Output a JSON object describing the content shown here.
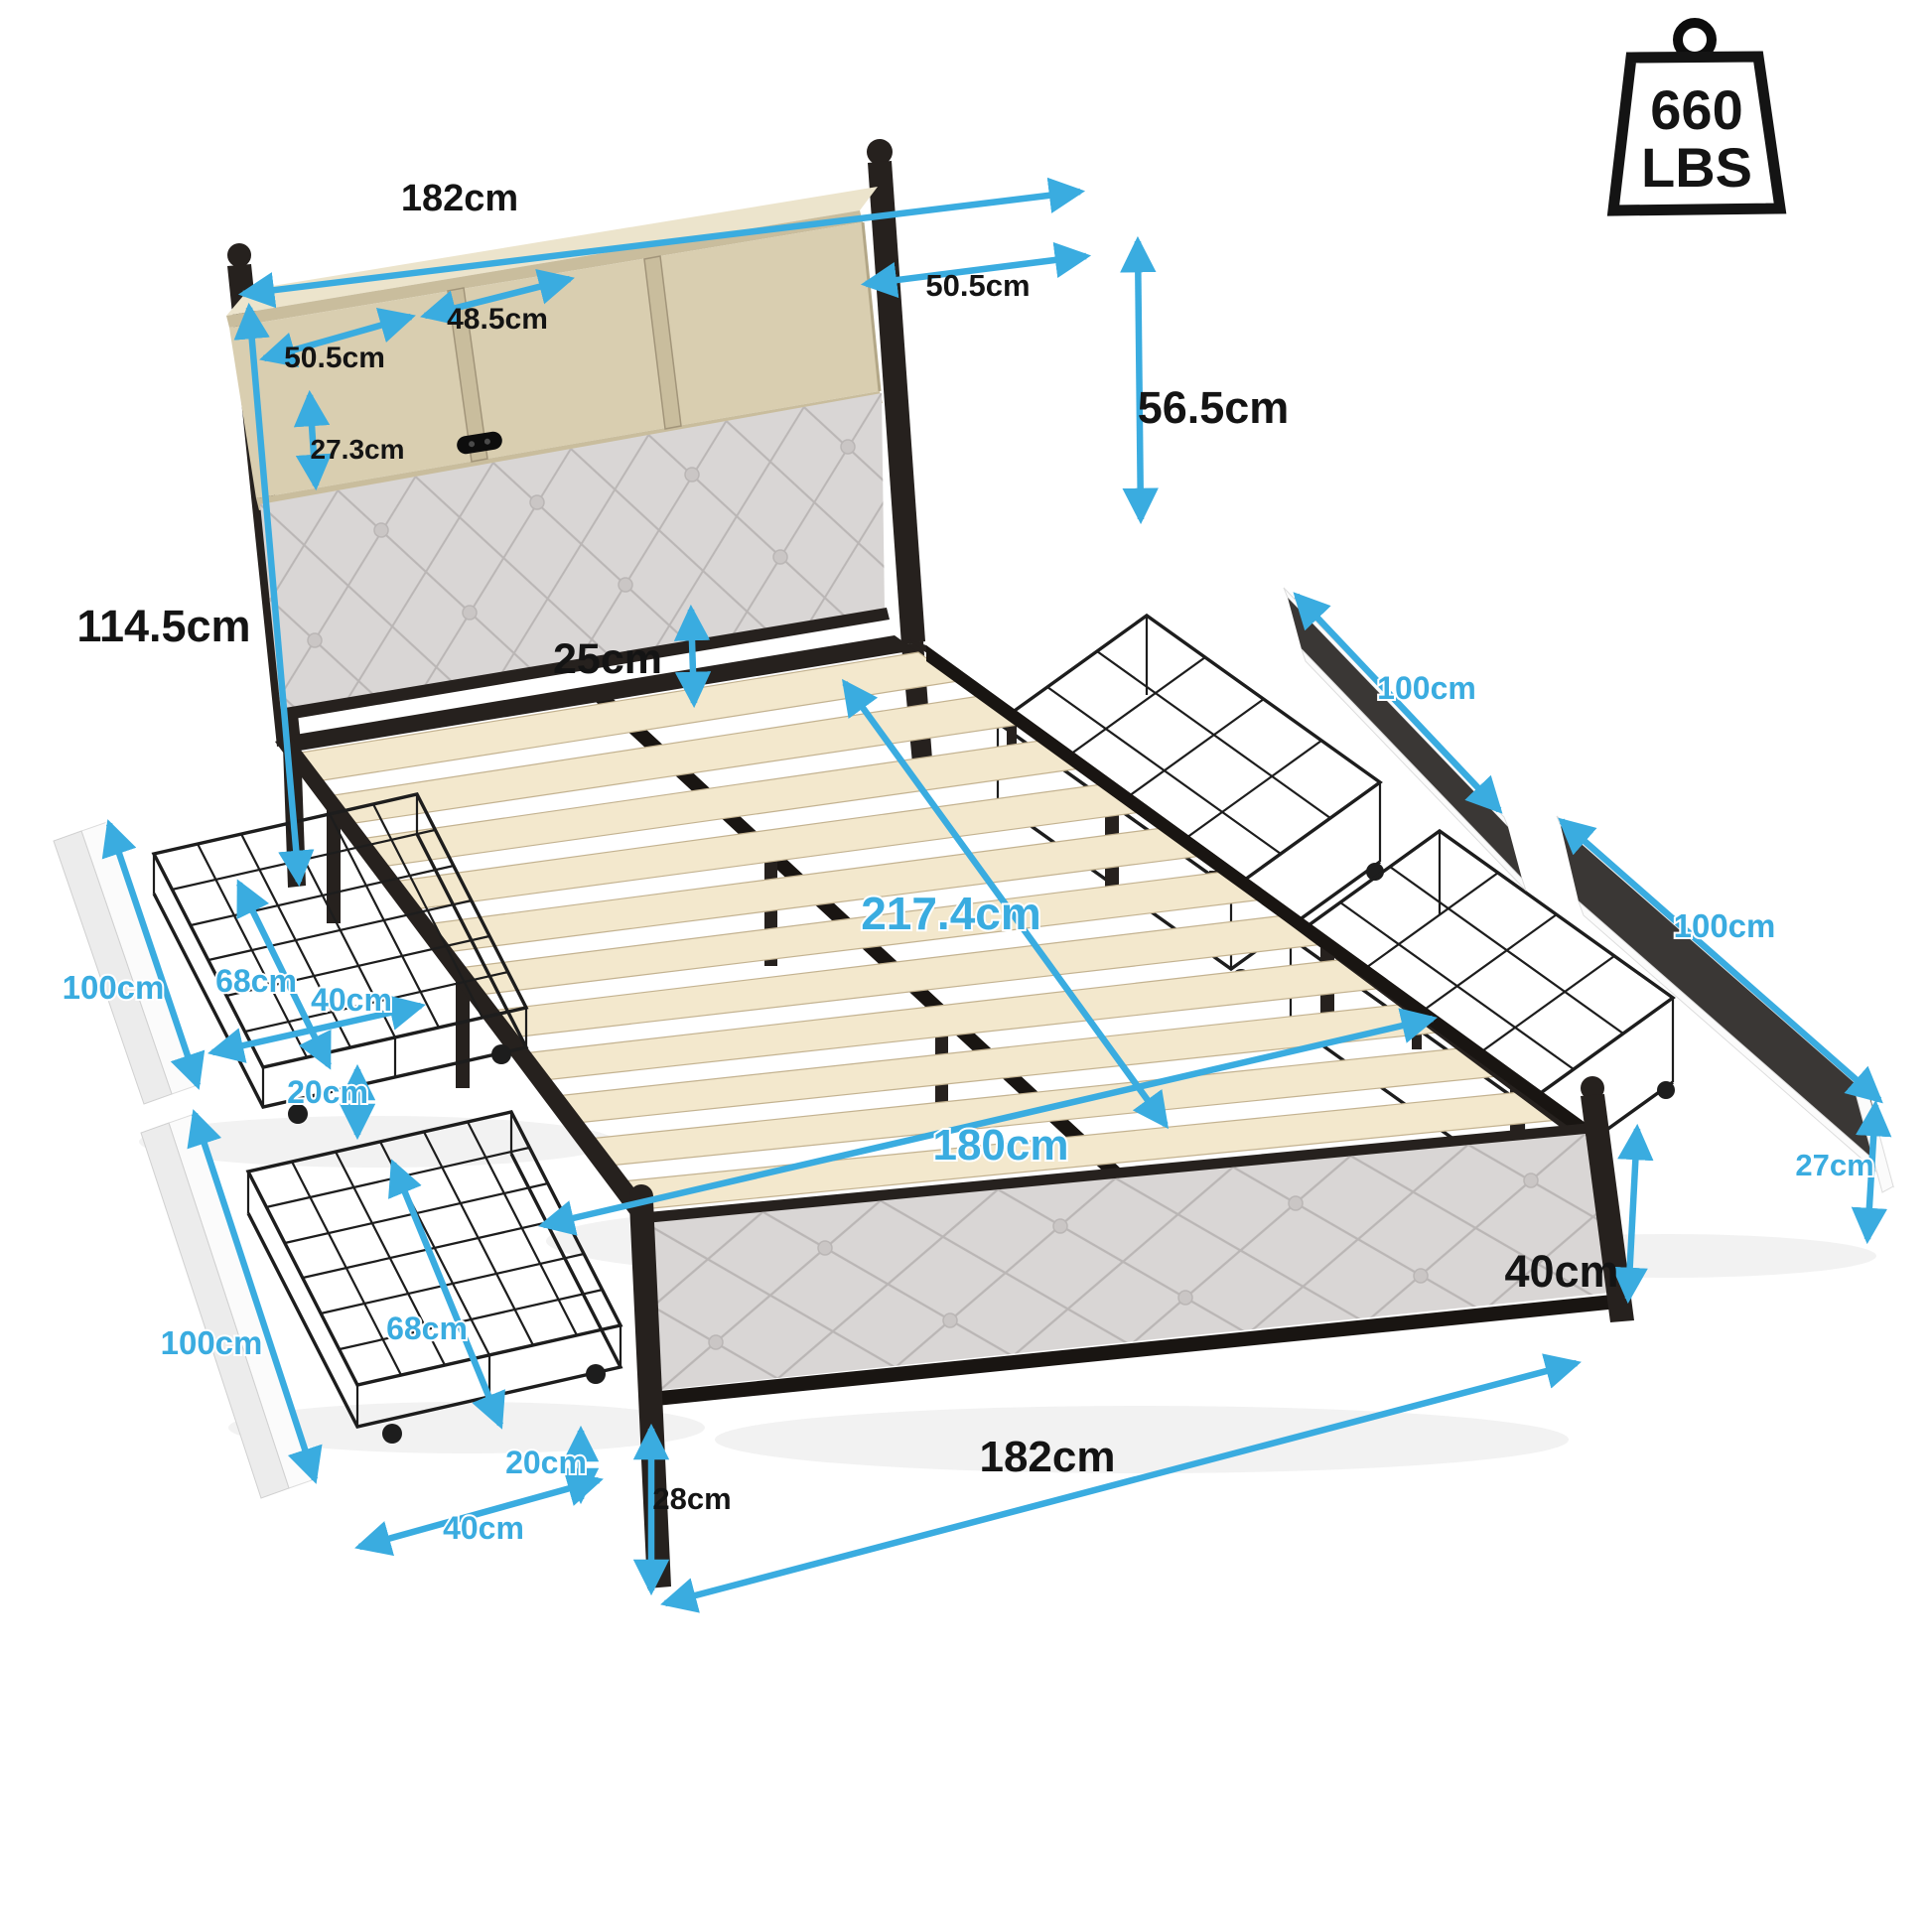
{
  "meta": {
    "kind": "product dimension diagram",
    "subject": "metal storage bed frame with bookcase headboard, charging station, wood slats and 4 under-bed wire drawers"
  },
  "colors": {
    "bg": "#ffffff",
    "accent": "#3aace0",
    "ink": "#141414",
    "metal": "#26211e",
    "metal2": "#191512",
    "wood": "#d9ceb0",
    "woodDark": "#c9bd9d",
    "woodTop": "#ece4cc",
    "slat": "#f3e8cd",
    "slatEdge": "#c3b290",
    "cushion": "#d9d6d5",
    "seam": "#bab6b5",
    "button": "#cac6c5",
    "wire": "#1d1d1d",
    "panelDark": "#3a3735"
  },
  "weight_capacity": {
    "value": "660",
    "unit": "LBS"
  },
  "dimensions": {
    "headboard_width": "182cm",
    "shelf_left": "50.5cm",
    "shelf_middle": "48.5cm",
    "shelf_right": "50.5cm",
    "shelf_depth": "27.3cm",
    "headboard_upper_height": "56.5cm",
    "headboard_total_height": "114.5cm",
    "headboard_clearance": "25cm",
    "total_length": "217.4cm",
    "slat_width": "180cm",
    "right_drawer1_length": "100cm",
    "right_drawer2_length": "100cm",
    "drawer_panel_height": "27cm",
    "footboard_height": "40cm",
    "footboard_leg_height": "28cm",
    "base_width": "182cm",
    "left_drawer1_length": "100cm",
    "left_drawer1_depth": "68cm",
    "left_drawer1_width": "40cm",
    "left_drawer1_height": "20cm",
    "left_drawer2_length": "100cm",
    "left_drawer2_depth": "68cm",
    "left_drawer2_height": "20cm",
    "left_drawer2_width": "40cm"
  }
}
